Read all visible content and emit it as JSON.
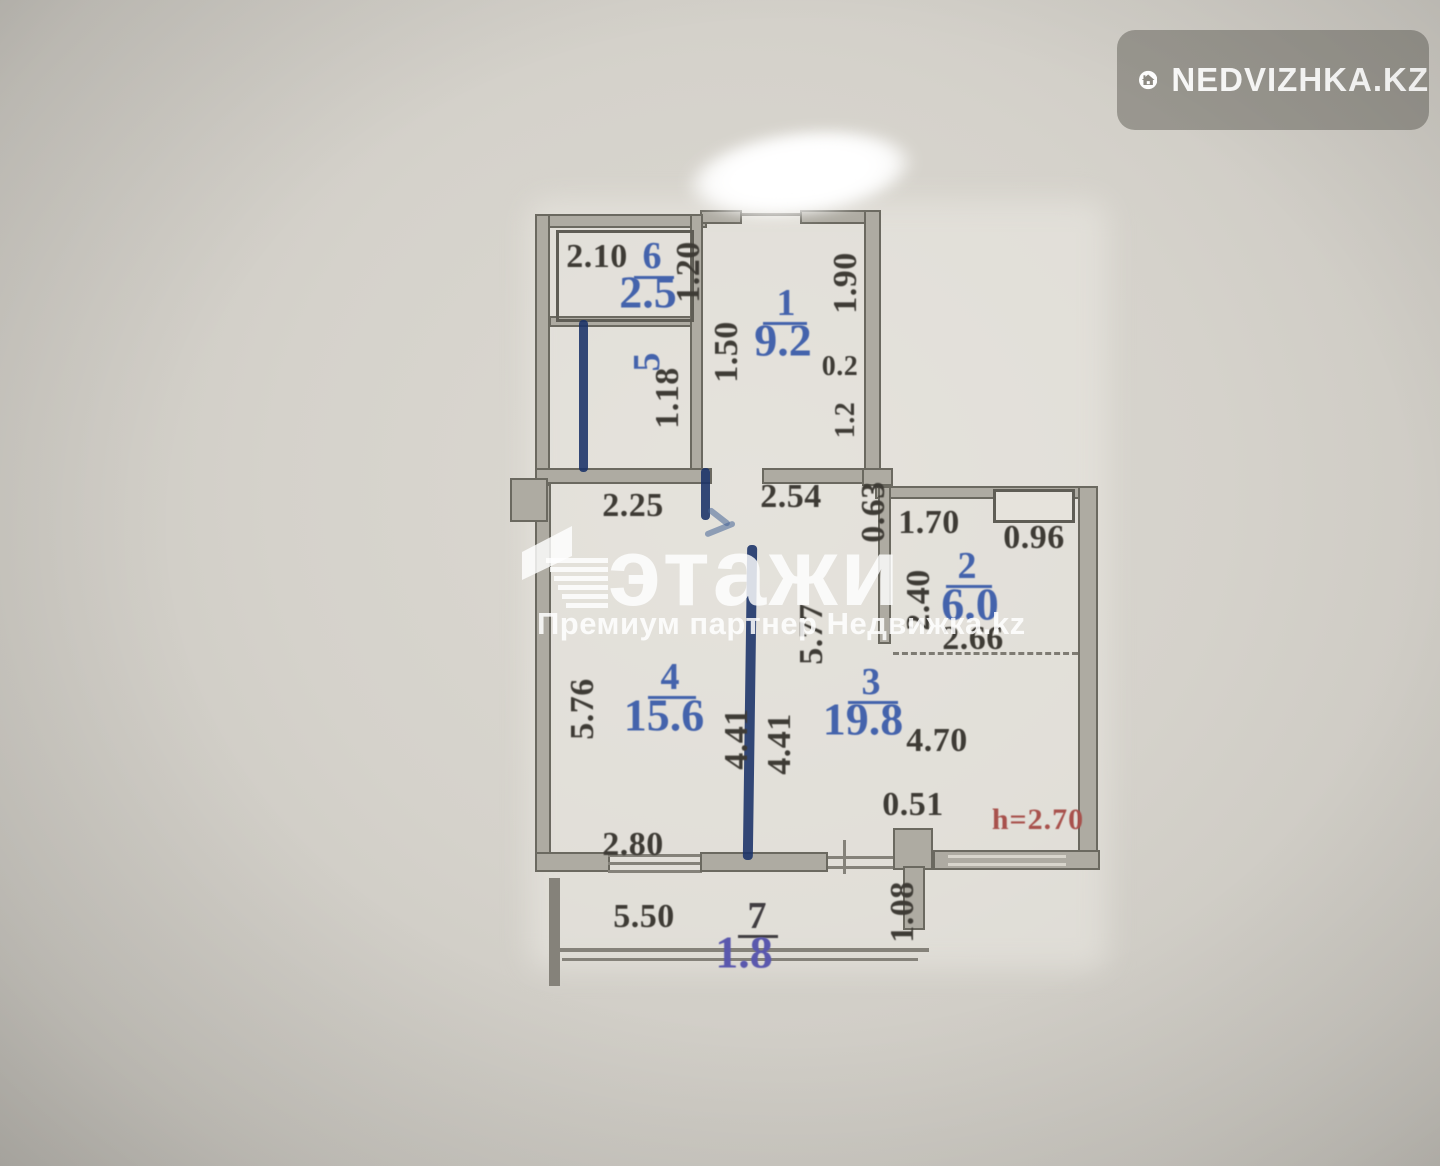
{
  "overlay": {
    "badge_text": "NEDVIZHKA.KZ",
    "watermark_brand": "этажи",
    "watermark_subtitle": "Премиум партнер Недвижка.kz"
  },
  "plan": {
    "height_label": "h=2.70",
    "rooms": {
      "r1": {
        "num": "1",
        "area": "9.2"
      },
      "r2": {
        "num": "2",
        "area": "6.0"
      },
      "r3": {
        "num": "3",
        "area": "19.8"
      },
      "r4": {
        "num": "4",
        "area": "15.6"
      },
      "r5": {
        "num": "5"
      },
      "r6": {
        "num": "6",
        "area": "2.5"
      },
      "r7": {
        "num": "7",
        "area": "1.8"
      }
    },
    "dims": {
      "d210": "2.10",
      "d120": "1.20",
      "d118": "1.18",
      "d150": "1.50",
      "d190": "1.90",
      "d02": "0.2",
      "d12": "1.2",
      "d225": "2.25",
      "d254": "2.54",
      "d063": "0.63",
      "d170": "1.70",
      "d096": "0.96",
      "d266": "2.66",
      "d240": "2.40",
      "d576": "5.76",
      "d577": "5.77",
      "d441a": "4.41",
      "d441b": "4.41",
      "d470": "4.70",
      "d051": "0.51",
      "d280": "2.80",
      "d550": "5.50",
      "d108": "1.08"
    }
  },
  "colors": {
    "ink_blue": "#4463ac",
    "marker_blue": "#193168",
    "dim_black": "#3e3b35",
    "height_red": "#a8514c",
    "wall_fill": "#aeaba2"
  }
}
